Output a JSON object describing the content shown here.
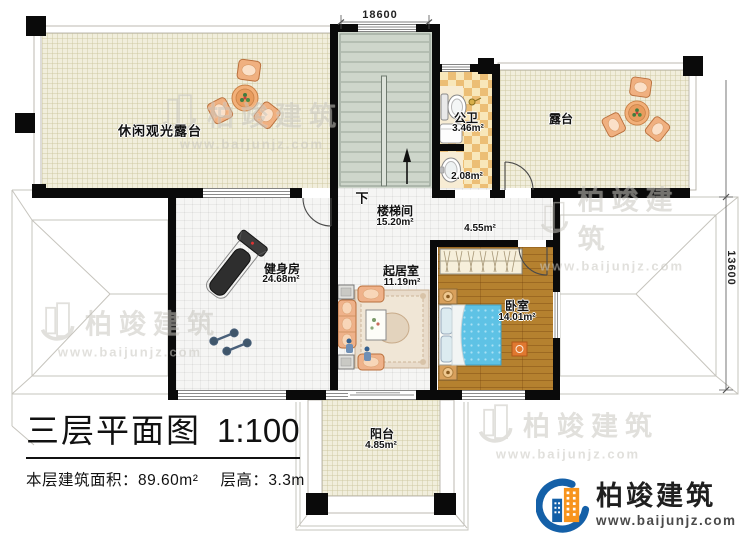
{
  "title_block": {
    "title": "三层平面图",
    "scale": "1:100",
    "floor_area_label": "本层建筑面积：89.60m²",
    "floor_height_label": "层高：3.3m"
  },
  "dimensions": {
    "top": "18600",
    "right": "13600"
  },
  "stairs": {
    "down_label": "下"
  },
  "rooms": {
    "leisure_terrace": {
      "name": "休闲观光露台"
    },
    "bathroom": {
      "name": "公卫",
      "area": "3.46m²",
      "sub_area": "2.08m²"
    },
    "terrace": {
      "name": "露台"
    },
    "stairwell": {
      "name": "楼梯间",
      "area": "15.20m²"
    },
    "corridor": {
      "area": "4.55m²"
    },
    "gym": {
      "name": "健身房",
      "area": "24.68m²"
    },
    "living_room": {
      "name": "起居室",
      "area": "11.19m²"
    },
    "bedroom": {
      "name": "卧室",
      "area": "14.01m²"
    },
    "balcony": {
      "name": "阳台",
      "area": "4.85m²"
    }
  },
  "watermark": {
    "brand": "柏竣建筑",
    "url": "www.baijunjz.com"
  },
  "logo": {
    "brand": "柏竣建筑",
    "url": "www.baijunjz.com"
  },
  "colors": {
    "wall": "#0a0a0a",
    "terrace_floor": "#f1eedc",
    "stair_floor": "#ced6cb",
    "bath_tile_dark": "#ecbe75",
    "bath_tile_light": "#f8e7ba",
    "wood_floor": "#b5812f",
    "bed_blanket": "#5ec2e5",
    "sofa": "#efb28a",
    "logo_blue": "#1460a8",
    "logo_orange": "#f7941d"
  }
}
